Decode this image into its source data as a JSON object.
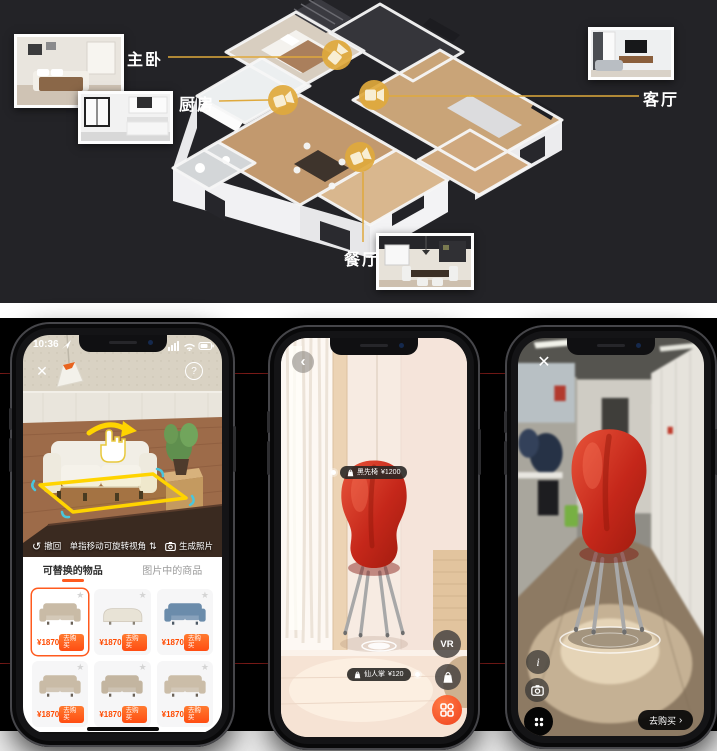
{
  "colors": {
    "gold": "#dfa93c",
    "accent_orange": "#ff5a1e",
    "price_orange": "#ff4a00",
    "guide_red": "#8f1f1c",
    "chair_red": "#c5271a"
  },
  "icons": {
    "close": "✕",
    "help": "?",
    "back": "‹",
    "chevron": "›",
    "undo": "↺",
    "updown": "⇅",
    "info": "i",
    "star": "★"
  },
  "floorplan": {
    "bedroom": "主卧",
    "kitchen": "厨房",
    "living": "客厅",
    "dining": "餐厅"
  },
  "left_phone": {
    "status_time": "10:36",
    "toolbar": {
      "undo_label": "撤回",
      "hint": "单指移动可旋转视角",
      "generate_label": "生成照片"
    },
    "tabs": {
      "replaceable": "可替换的物品",
      "in_image": "图片中的商品"
    },
    "products": [
      {
        "price": "¥1870",
        "buy_label": "去购买",
        "color": "#c9bba6"
      },
      {
        "price": "¥1870",
        "buy_label": "去购买",
        "color": "#e8e3d6"
      },
      {
        "price": "¥1870",
        "buy_label": "去购买",
        "color": "#6b8cab"
      },
      {
        "price": "¥1870",
        "buy_label": "去购买",
        "color": "#c9bba6"
      },
      {
        "price": "¥1870",
        "buy_label": "去购买",
        "color": "#c3b5a0"
      },
      {
        "price": "¥1870",
        "buy_label": "去购买",
        "color": "#cbbda8"
      }
    ]
  },
  "middle_phone": {
    "chair_tag": {
      "name": "黑先椅",
      "price": "¥1200"
    },
    "floor_tag": {
      "name": "仙人掌",
      "price": "¥120"
    },
    "vr_label": "VR"
  },
  "right_phone": {
    "buy_label": "去购买"
  }
}
